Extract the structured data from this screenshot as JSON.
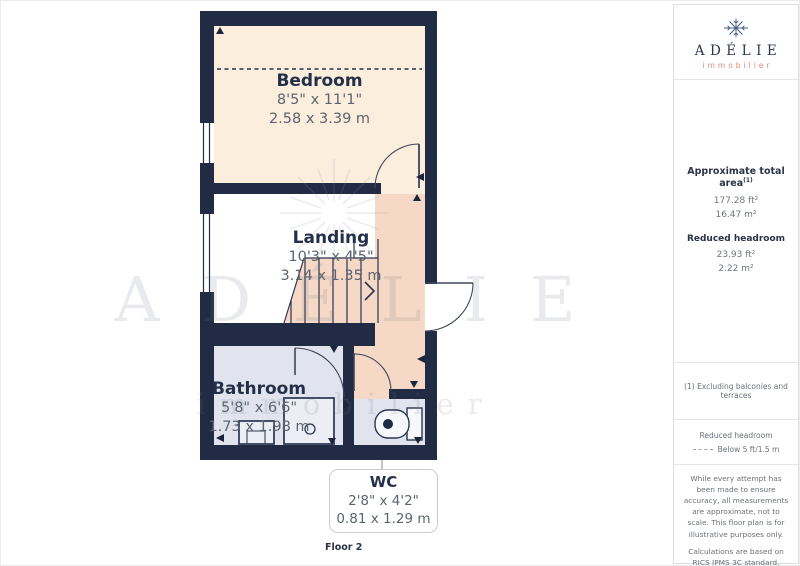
{
  "branding": {
    "name": "ADÉLIE",
    "tagline": "immobilier"
  },
  "sidebar": {
    "area_summary": {
      "total_label": "Approximate total area",
      "total_ref": "(1)",
      "total_ft": "177.28 ft²",
      "total_m": "16.47 m²",
      "reduced_label": "Reduced headroom",
      "reduced_ft": "23.93 ft²",
      "reduced_m": "2.22 m²"
    },
    "footnote": "(1) Excluding balconies and terraces",
    "legend": {
      "title": "Reduced headroom",
      "item": "Below 5 ft/1.5 m"
    },
    "disclaimer_1": "While every attempt has been made to ensure accuracy, all measurements are approximate, not to scale. This floor plan is for illustrative purposes only.",
    "disclaimer_2": "Calculations are based on RICS IPMS 3C standard.",
    "brand_footer": {
      "name": "GIRAFFE",
      "suffix": "360"
    }
  },
  "floor_label": "Floor 2",
  "rooms": {
    "bedroom": {
      "name": "Bedroom",
      "imperial": "8'5\" x 11'1\"",
      "metric": "2.58 x 3.39 m"
    },
    "landing": {
      "name": "Landing",
      "imperial": "10'3\" x 4'5\"",
      "metric": "3.14 x 1.35 m"
    },
    "bathroom": {
      "name": "Bathroom",
      "imperial": "5'8\" x 6'6\"",
      "metric": "1.73 x 1.98 m"
    },
    "wc": {
      "name": "WC",
      "imperial": "2'8\" x 4'2\"",
      "metric": "0.81 x 1.29 m"
    }
  },
  "watermark": {
    "name": "ADÉLIE",
    "tagline": "immobilier"
  },
  "colors": {
    "wall": "#212c44",
    "bedroom_floor": "#fceedd",
    "reduced_headroom_floor": "#f5d8c5",
    "bathroom_floor": "#e1e4ef",
    "brand_navy": "#2c3652",
    "brand_salmon": "#de8a79"
  }
}
